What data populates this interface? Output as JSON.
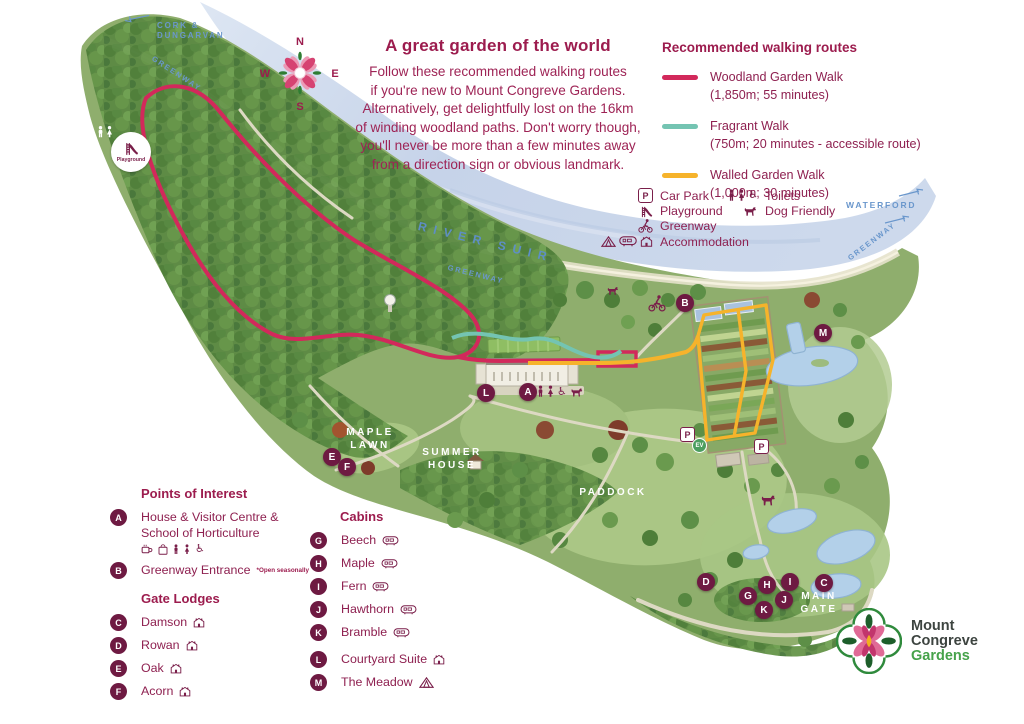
{
  "intro": {
    "title": "A great garden of the world",
    "body_lines": [
      "Follow these recommended walking routes",
      "if you're new to Mount Congreve Gardens.",
      "Alternatively, get delightfully lost on the 16km",
      "of winding woodland paths. Don't worry though,",
      "you'll never be more than a few minutes away",
      "from a direction sign or obvious landmark."
    ]
  },
  "routes_legend": {
    "title": "Recommended walking routes",
    "items": [
      {
        "name": "Woodland Garden Walk",
        "detail": "(1,850m; 55 minutes)",
        "color": "#d2295b"
      },
      {
        "name": "Fragrant Walk",
        "detail": "(750m; 20 minutes - accessible route)",
        "color": "#74c4b2"
      },
      {
        "name": "Walled Garden Walk",
        "detail": "(1,000m; 30 minutes)",
        "color": "#f6b32b"
      }
    ]
  },
  "amenity_legend": {
    "column1": [
      {
        "icon": "car-park-icon",
        "label": "Car Park"
      },
      {
        "icon": "playground-icon",
        "label": "Playground"
      },
      {
        "icon": "greenway-icon",
        "label": "Greenway"
      },
      {
        "icon": "accommodation-icons",
        "label": "Accommodation"
      }
    ],
    "column2": [
      {
        "icon": "toilets-icon",
        "label": "Toilets"
      },
      {
        "icon": "dog-icon",
        "label": "Dog Friendly"
      }
    ]
  },
  "map_labels": {
    "cork_line1": "CORK &",
    "cork_line2": "DUNGARVAN",
    "river": "RIVER SUIR",
    "greenway": "GREENWAY",
    "waterford": "WATERFORD",
    "maple_line1": "MAPLE",
    "maple_line2": "LAWN",
    "summer_line1": "SUMMER",
    "summer_line2": "HOUSE",
    "paddock": "PADDOCK",
    "gate_line1": "MAIN",
    "gate_line2": "GATE"
  },
  "compass": {
    "n": "N",
    "e": "E",
    "s": "S",
    "w": "W"
  },
  "markers": {
    "a": "A",
    "b": "B",
    "c": "C",
    "d": "D",
    "e": "E",
    "f": "F",
    "g": "G",
    "h": "H",
    "i": "I",
    "j": "J",
    "k": "K",
    "l": "L",
    "m": "M"
  },
  "badges": {
    "parking": "P",
    "ev": "EV",
    "playground": "Playground"
  },
  "poi": {
    "title": "Points of Interest",
    "a_line1": "House & Visitor Centre &",
    "a_line2": "School of Horticulture",
    "b_name": "Greenway Entrance",
    "b_note": "*Open seasonally",
    "gate_lodges_title": "Gate Lodges",
    "gate_lodges": [
      {
        "letter": "C",
        "name": "Damson"
      },
      {
        "letter": "D",
        "name": "Rowan"
      },
      {
        "letter": "E",
        "name": "Oak"
      },
      {
        "letter": "F",
        "name": "Acorn"
      }
    ]
  },
  "cabins": {
    "title": "Cabins",
    "items": [
      {
        "letter": "G",
        "name": "Beech"
      },
      {
        "letter": "H",
        "name": "Maple"
      },
      {
        "letter": "I",
        "name": "Fern"
      },
      {
        "letter": "J",
        "name": "Hawthorn"
      },
      {
        "letter": "K",
        "name": "Bramble"
      }
    ],
    "suite_letter": "L",
    "suite_name": "Courtyard Suite",
    "meadow_letter": "M",
    "meadow_name": "The Meadow"
  },
  "logo": {
    "line1": "Mount",
    "line2": "Congreve",
    "line3": "Gardens"
  },
  "colors": {
    "brand_magenta": "#9c1c4e",
    "marker_burgundy": "#6e1a42",
    "route_pink": "#d2295b",
    "route_teal": "#74c4b2",
    "route_yellow": "#f6b32b",
    "label_blue": "#6a97cc",
    "river_blue": "#c6d3e9",
    "logo_green": "#46a24a"
  }
}
